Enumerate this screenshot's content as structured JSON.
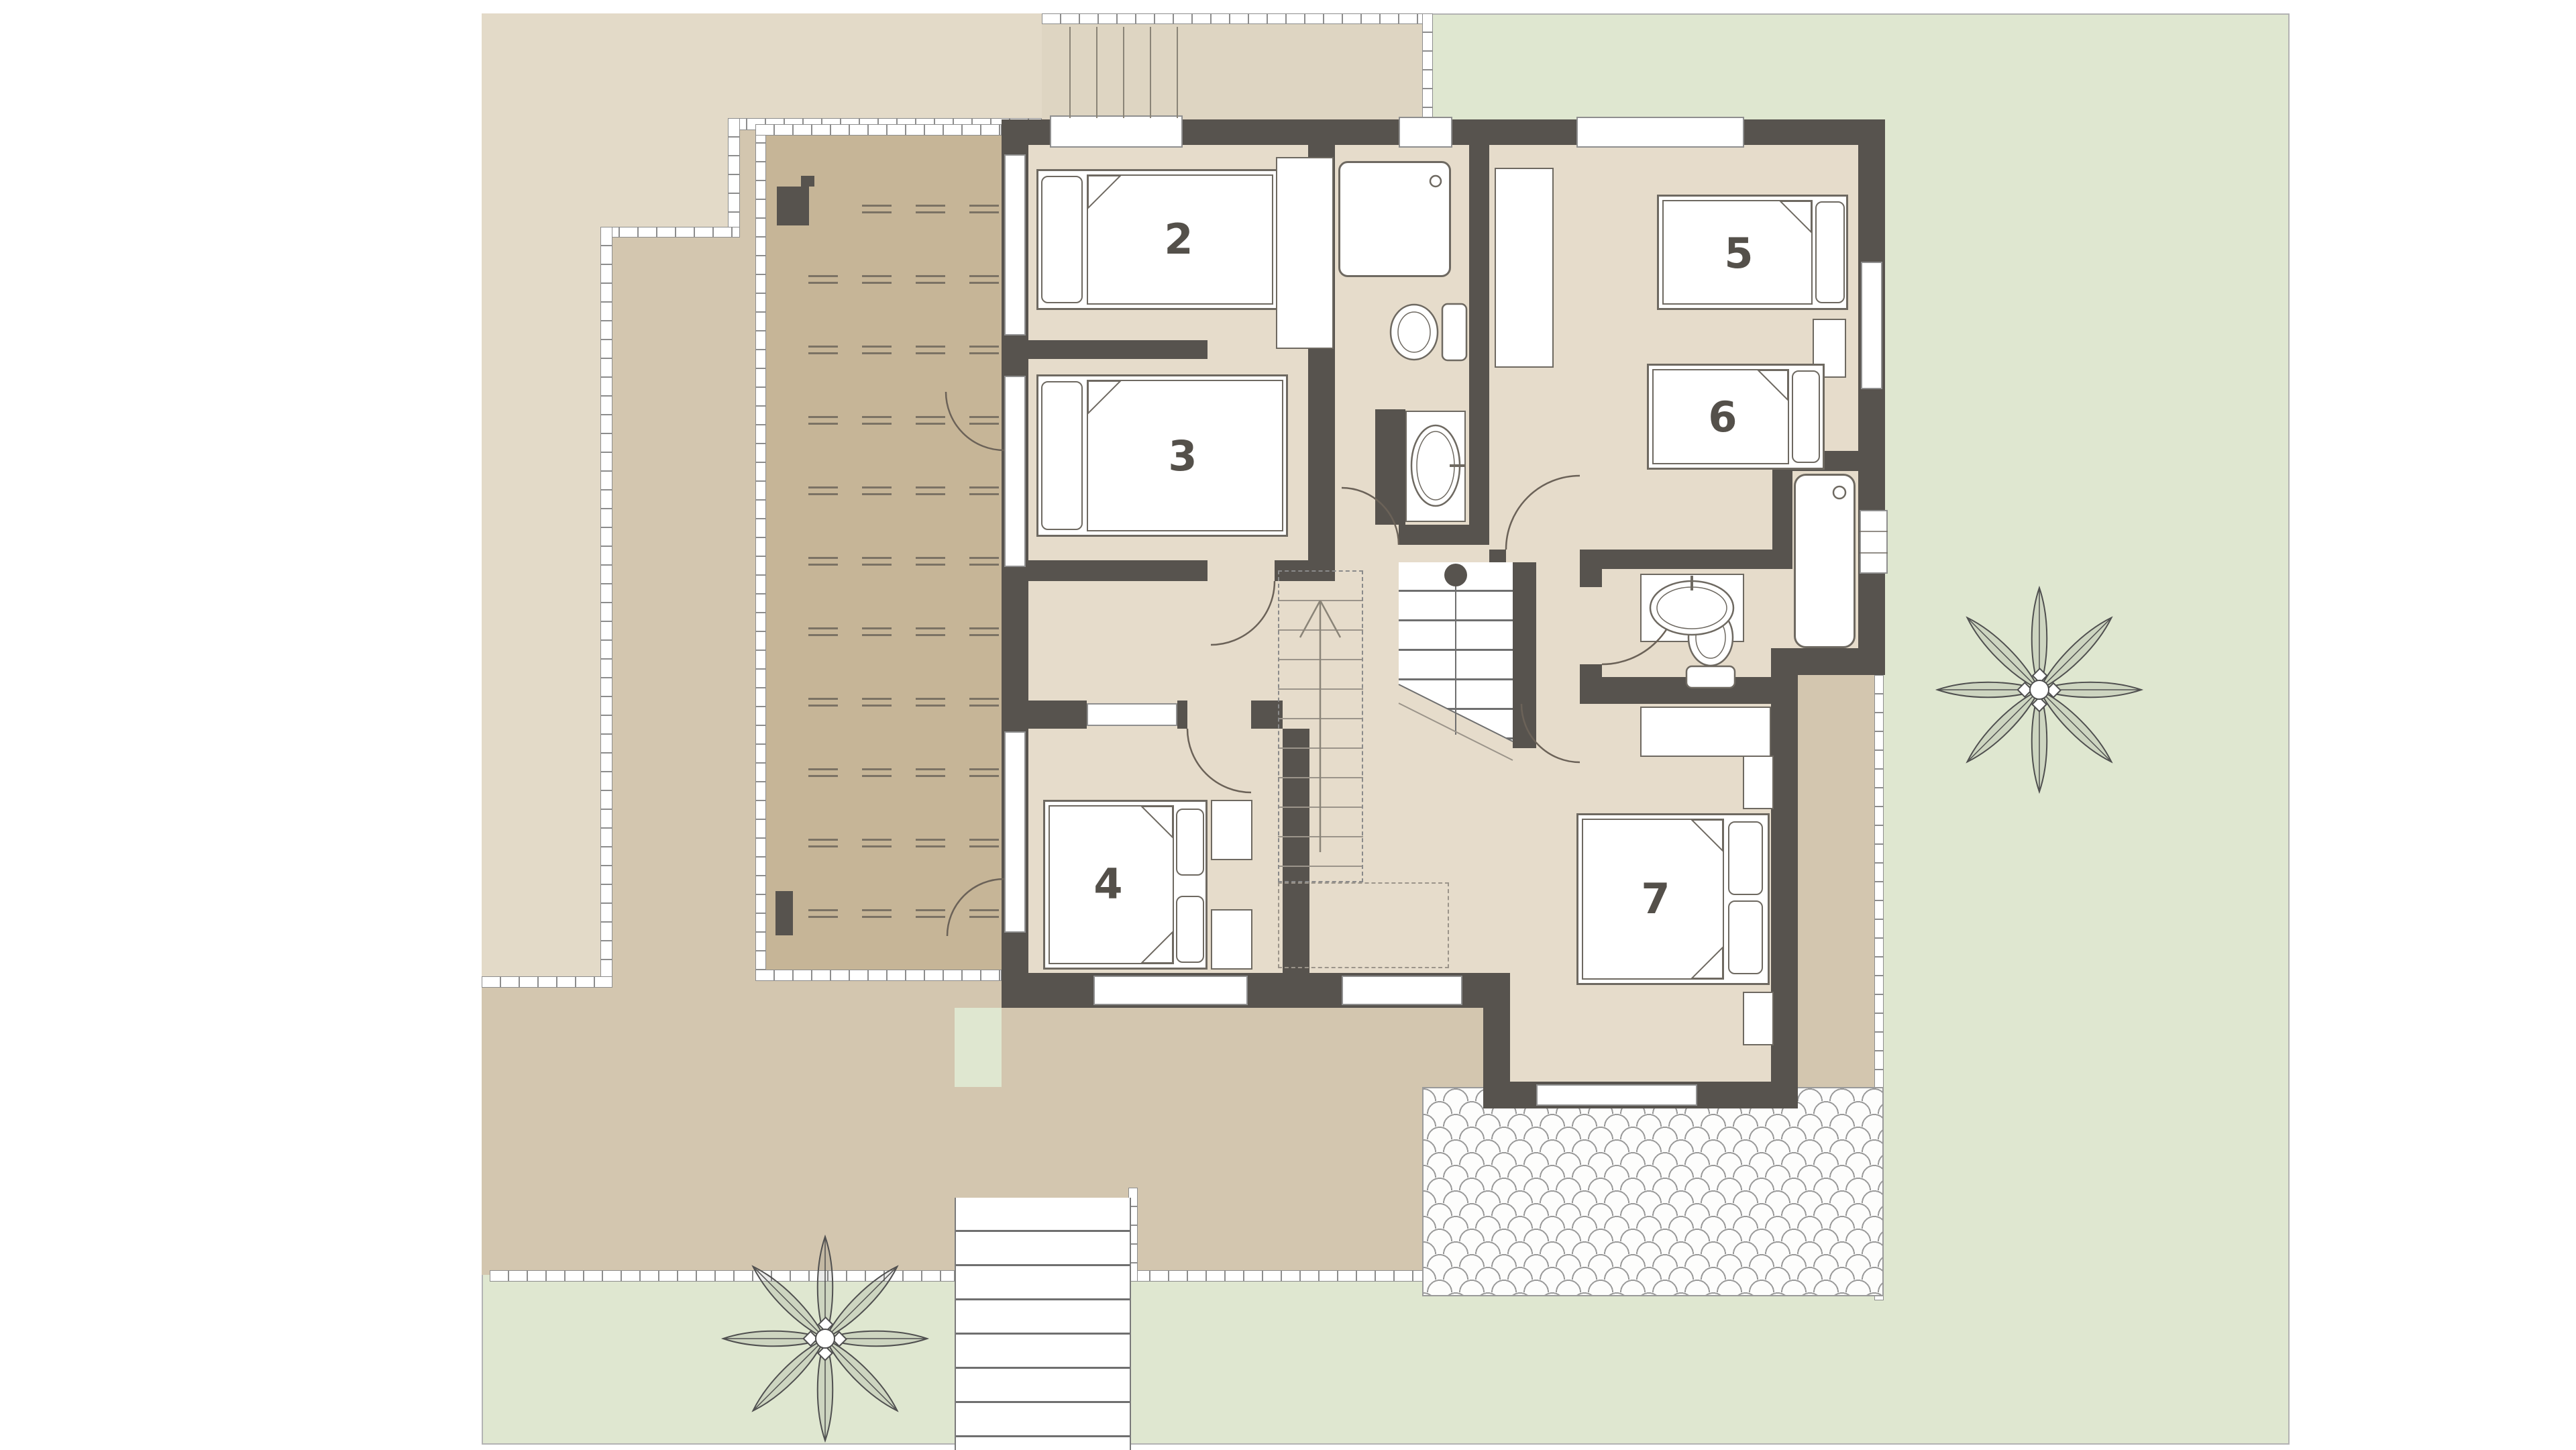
{
  "plan": {
    "type": "floor-plan",
    "level": "upper-floor",
    "room_numbers": {
      "r2": "2",
      "r3": "3",
      "r4": "4",
      "r5": "5",
      "r6": "6",
      "r7": "7"
    }
  },
  "colors": {
    "garden": "#dfe7d0",
    "ground": "#d3c6af",
    "roof_deck": "#e3dac8",
    "back_terrace": "#ded5c2",
    "terrace": "#c6b597",
    "floor": "#e6dccb",
    "wall": "#57534e",
    "line": "#6e6961",
    "number": "#54504a",
    "fence_line": "#8d8d8d",
    "tile_line": "#9a9a9a",
    "plant": "#555555"
  },
  "icons": {
    "plant": "8-petal-shrub-symbol",
    "stairs_up": "dashed-flight-with-arrow",
    "bed": "rect-with-pillow-and-fold",
    "toilet": "oval-bowl-with-tank",
    "sink": "oval-basin-in-counter",
    "shower": "rounded-square-with-drain",
    "bathtub": "rounded-rect-with-drain"
  },
  "terrace_marks": {
    "cols": [
      1205,
      1285,
      1365,
      1445
    ],
    "rows": [
      305,
      410,
      515,
      620,
      725,
      830,
      935,
      1040,
      1145,
      1250,
      1355
    ],
    "width": 44,
    "gap": 10
  }
}
